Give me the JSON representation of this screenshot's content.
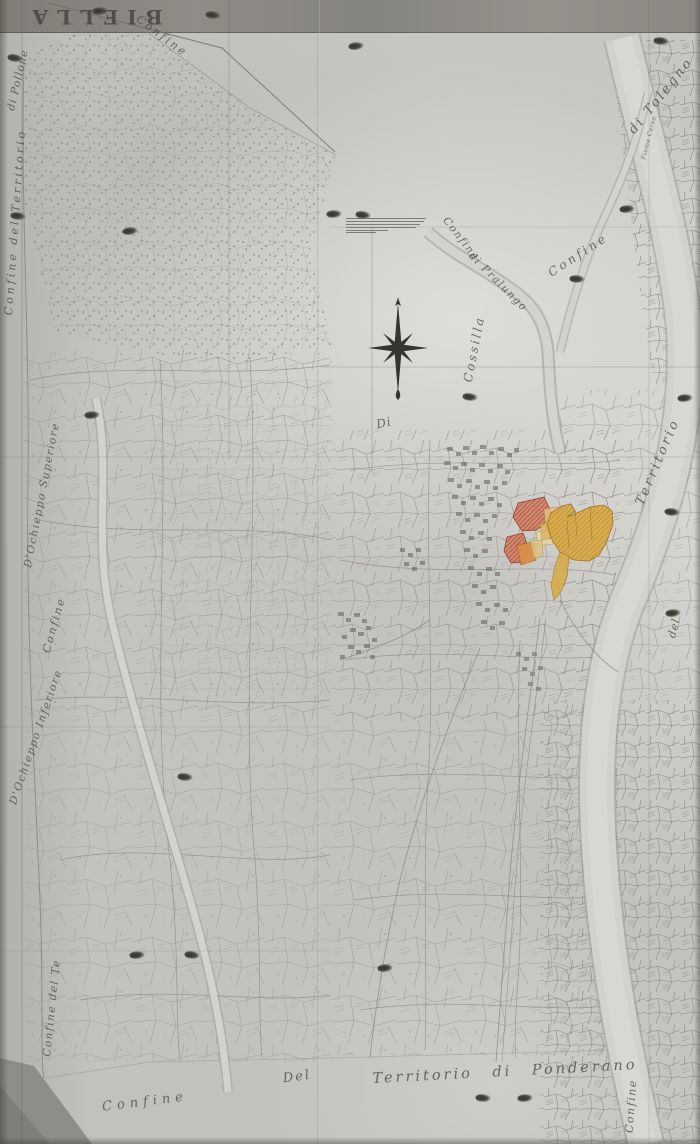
{
  "map": {
    "title": "BIELLA",
    "labels": {
      "confine_top": "Confine",
      "di_pollone": "di Pollone",
      "confine_del_territorio_left": "Confine del Territorio",
      "dochieppo_superiore": "D'Ochieppo Superiore",
      "confine_left": "Confine",
      "dochieppo_inferiore": "D'Ochieppo Inferiore",
      "confine_del_te_bottom_left": "Confine del Te",
      "confine_bottom": "Confine",
      "del_bottom": "Del",
      "territorio_di_ponderano": "Territorio di Ponderano",
      "confine_bottom_right": "Confine",
      "territorio_right": "Territorio",
      "del_right": "del",
      "confine_right": "Confine",
      "confine_stream": "Confine",
      "di_pralungo": "di Pralungo",
      "cossilla": "Cossilla",
      "di_center": "Di",
      "di_tolegno": "di Tolegno",
      "fiume_cervo": "Fiume Cervo"
    },
    "icons": {
      "compass": "eight-point-star-compass-rose",
      "boundary_marks": "ink-blot-boundary-marker"
    },
    "palette": {
      "paper": "#c6c5c1",
      "ink": "#55534c",
      "highlight_gold": "#d8a945",
      "highlight_pale_gold": "#e3c07f",
      "highlight_red": "#d08267",
      "highlight_orange": "#d98f45"
    }
  }
}
